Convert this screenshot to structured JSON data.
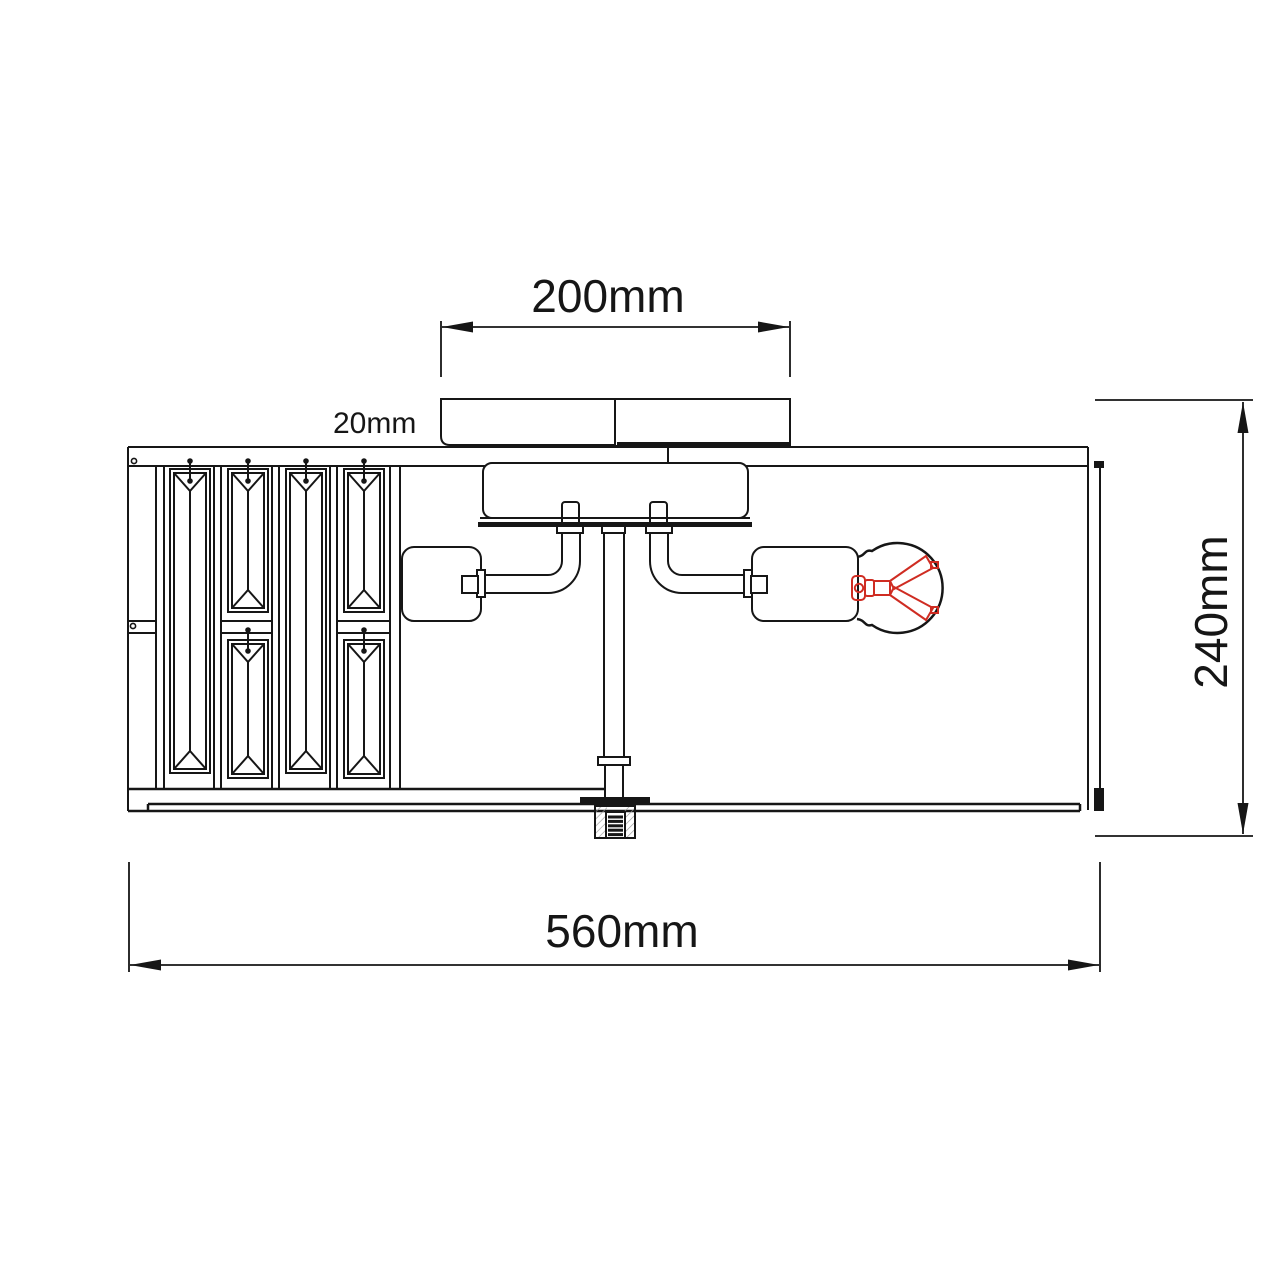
{
  "drawing": {
    "kind": "technical-dimension-drawing",
    "dimensions": {
      "canopy_width": "200mm",
      "canopy_height": "20mm",
      "fixture_height": "240mm",
      "fixture_width": "560mm"
    },
    "colors": {
      "line": "#161616",
      "filament_red": "#cf2c22",
      "hatch_gray": "#9a9a9a",
      "background": "#ffffff"
    }
  }
}
